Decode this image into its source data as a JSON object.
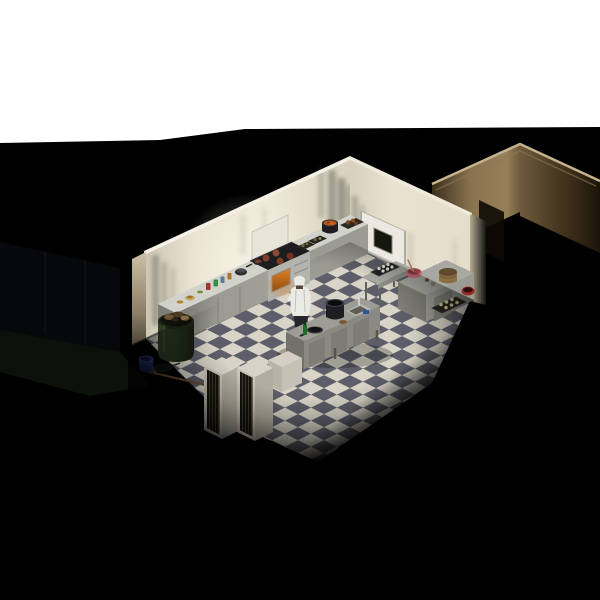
{
  "meta": {
    "style": "2:1 isometric survival-sim game scene",
    "scene": "commercial restaurant kitchen at night, interior lit, surrounded by darkness",
    "view": "single room with checkered floor, counters along two walls, center island, chef character at stove"
  },
  "labels": {
    "scene": "isometric kitchen scene",
    "white_band": "overexposed white band at top of frame",
    "hallway": "dark hallway wall outside kitchen, upper right",
    "wood_floor": "wood floorboards outside kitchen doorway",
    "nw_wall": "kitchen back-left wall with grime stains",
    "ne_wall": "kitchen back-right wall",
    "door": "white door with dark window",
    "light_switch": "wall light switch",
    "floor": "black and white checkered tile floor",
    "counter_a": "left counter with canned goods and plates of food",
    "stove": "stainless range with lit oven and burgers on griddle",
    "counter_b": "counter with food trays",
    "counter_c": "corner counter with stew pot and roast tray",
    "backsplash": "white wall panel behind stove",
    "chef": "chef character in white jacket and chef hat",
    "island": "stainless center island with stock pot, pan and sink",
    "low_cabinet": "small cabinet near racks",
    "table_d": "metal prep table with egg tray",
    "counter_e": "right counter with pink mixing bowl, basket, red pot and pastry tray",
    "racks": "two tall dark-slotted storage racks",
    "barrel": "green trash barrel full of garbage",
    "broom": "broom lying on floor",
    "bucket": "blue bucket on floor",
    "pan_floor": "black pan on floor",
    "egg_carton": "egg carton on floor"
  },
  "palette": {
    "bg": "#000000",
    "white-band": "#ffffff",
    "wall-a": "#e9e2d1",
    "wall-b": "#d9d1be",
    "wall-cap": "#f4f0e4",
    "wall-grime": "#50544a",
    "white-panel": "#e7e4da",
    "floor-light": "#d8d4c7",
    "floor-dark": "#5e5e6a",
    "counter-top": "#d2d2cc",
    "counter-front": "#9b9b93",
    "counter-side": "#7e7e76",
    "counter-panel": "#85857d",
    "stainless": "#b4b4ae",
    "cooktop": "#1d1d1f",
    "oven-glow-a": "#d97c24",
    "oven-glow-b": "#7a3a08",
    "burger": "#7c3c28",
    "door-fill": "#ebe9e2",
    "door-frame": "#b0ac9f",
    "door-window": "#16160f",
    "switch-fill": "#dde8ea",
    "island-top": "#9d9d96",
    "island-front": "#8a8a82",
    "island-side": "#72726a",
    "table-top": "#a8a8a2",
    "table-leg": "#60605a",
    "rack-top": "#d8d3c6",
    "rack-body": "#c9c4b6",
    "rack-side": "#b2ad9f",
    "rack-slot": "#16130e",
    "rack-bar": "#403a2c",
    "barrel-body": "#2f4028",
    "barrel-dark": "#141c10",
    "trash-brown": "#6b5334",
    "chef-white": "#ebebe5",
    "chef-pants": "#26262a",
    "pot-black": "#1e1e22",
    "pot-rim": "#3e3e46",
    "stew-orange": "#b5581c",
    "roast-brown": "#7a4318",
    "tray-dark": "#26261e",
    "food-green": "#6b6b3a",
    "bowl-pink": "#c96a74",
    "bowl-pink-dark": "#8f3d47",
    "basket": "#8a6f46",
    "pot-red": "#932824",
    "pastry": "#d9c99e",
    "egg-white": "#e6e2d6",
    "bottle-green": "#1e6b2a",
    "bucket-blue": "#2c4590",
    "bucket-blue-dark": "#131c3c",
    "pan-black": "#15151a",
    "wood-floor": "#9a7c4c",
    "wood-seam": "#66502e",
    "hall-trim": "#c4b48e",
    "hall-bright": "#96805a",
    "hall-mid": "#6e5a3c",
    "hall-dark": "#1c1409",
    "wedge-cream": "#ede5d2",
    "outside-panel": "#07080c",
    "outside-green": "#0c120a",
    "broom": "#6b4f2e"
  }
}
